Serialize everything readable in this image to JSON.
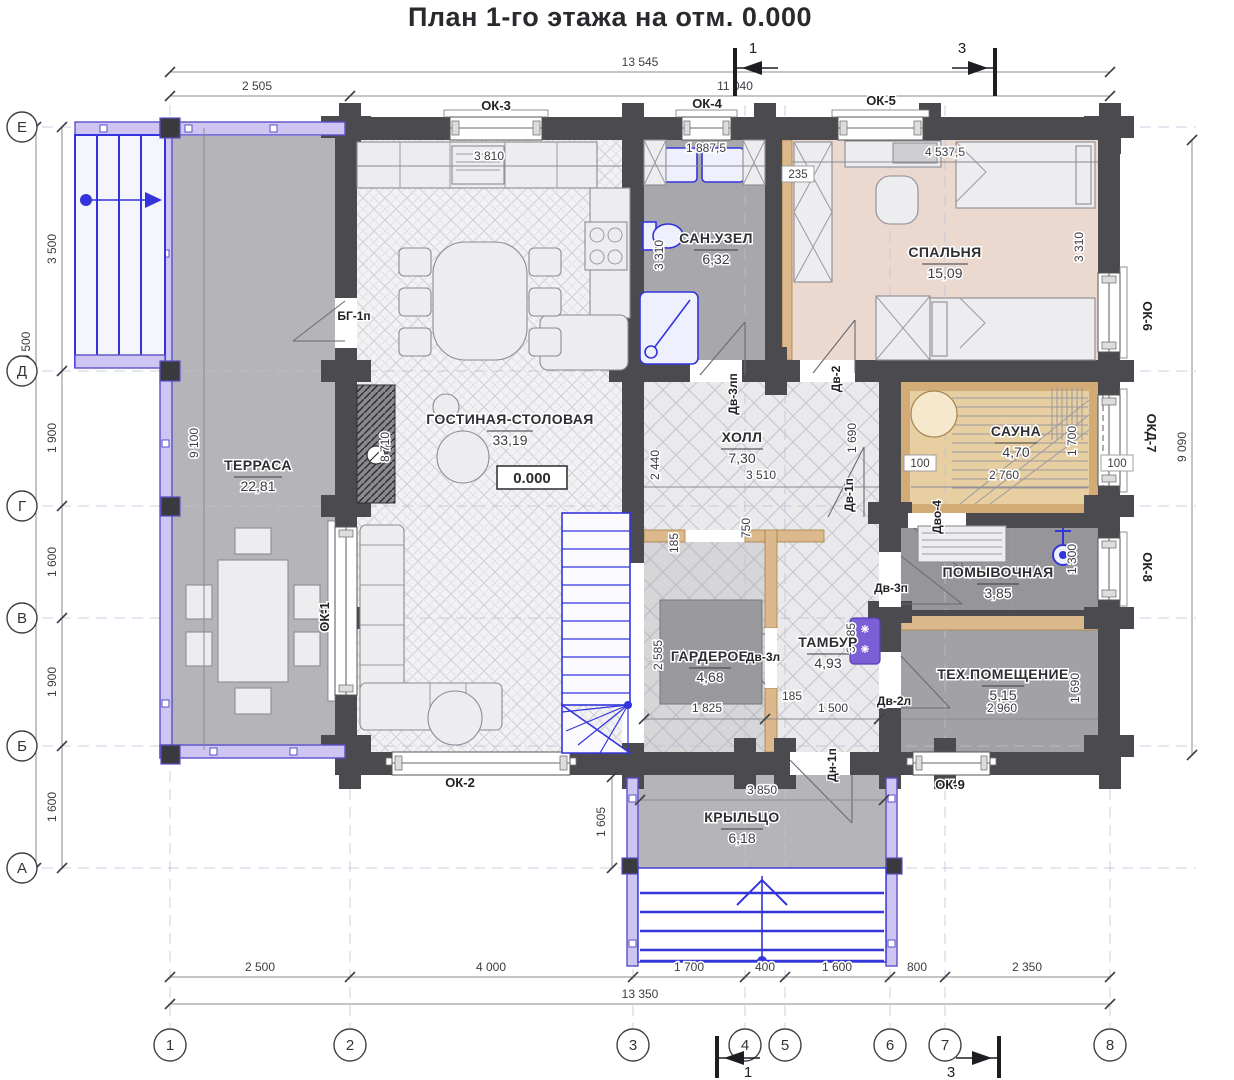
{
  "title": "План 1-го этажа на отм. 0.000",
  "elevation": "0.000",
  "rooms": {
    "terrasa": {
      "name": "ТЕРРАСА",
      "area": "22,81"
    },
    "gostinaya": {
      "name": "ГОСТИНАЯ-СТОЛОВАЯ",
      "area": "33,19"
    },
    "sanuzel": {
      "name": "САН.УЗЕЛ",
      "area": "6,32"
    },
    "spalnya": {
      "name": "СПАЛЬНЯ",
      "area": "15,09"
    },
    "holl": {
      "name": "ХОЛЛ",
      "area": "7,30"
    },
    "sauna": {
      "name": "САУНА",
      "area": "4,70"
    },
    "pomyvochnaya": {
      "name": "ПОМЫВОЧНАЯ",
      "area": "3,85"
    },
    "garderob": {
      "name": "ГАРДЕРОБ",
      "area": "4,68"
    },
    "tambur": {
      "name": "ТАМБУР",
      "area": "4,93"
    },
    "tehpom": {
      "name": "ТЕХ.ПОМЕЩЕНИЕ",
      "area": "5,15"
    },
    "krylco": {
      "name": "КРЫЛЬЦО",
      "area": "6,18"
    }
  },
  "windows": {
    "ok1": "ОК-1",
    "ok2": "ОК-2",
    "ok3": "ОК-3",
    "ok4": "ОК-4",
    "ok5": "ОК-5",
    "ok6": "ОК-6",
    "okd7": "ОКД-7",
    "ok8": "ОК-8",
    "ok9": "ОК-9"
  },
  "doors": {
    "bg1p": "БГ-1п",
    "dv3lp": "Дв-3лп",
    "dv2": "Дв-2",
    "dv1l": "Дв-1п",
    "dv3p": "Дв-3п",
    "dv3l": "Дв-3л",
    "dv2l": "Дв-2л",
    "dn1p": "Дн-1п",
    "dvo4": "Дво-4"
  },
  "axes": {
    "vertical": [
      "Е",
      "Д",
      "Г",
      "В",
      "Б",
      "А"
    ],
    "horizontal": [
      "1",
      "2",
      "3",
      "4",
      "5",
      "6",
      "7",
      "8"
    ]
  },
  "sections": {
    "one": "1",
    "three": "3"
  },
  "dimensions": {
    "top": {
      "total": "13 545",
      "inner": "11 040",
      "terrace": "2 505"
    },
    "bottom": {
      "segments": [
        "2 500",
        "4 000",
        "1 700",
        "400",
        "1 600",
        "800",
        "2 350"
      ],
      "total": "13 350"
    },
    "left": {
      "segments": [
        "3 500",
        "1 900",
        "1 600",
        "1 900",
        "1 600"
      ],
      "total": "10 500"
    },
    "right": {
      "total": "9 090"
    },
    "interior": {
      "d3810": "3 810",
      "d18875": "1 887,5",
      "d235": "235",
      "d45375": "4 537,5",
      "d3310a": "3 310",
      "d3310b": "3 310",
      "d9100": "9 100",
      "d8710": "8 710",
      "d2440": "2 440",
      "d3510": "3 510",
      "d1690a": "1 690",
      "d750": "750",
      "d185a": "185",
      "d100a": "100",
      "d2760": "2 760",
      "d1700": "1 700",
      "d100b": "100",
      "d1300": "1 300",
      "d2585": "2 585",
      "d1825": "1 825",
      "d185b": "185",
      "d1500": "1 500",
      "d3285": "3 285",
      "d2960": "2 960",
      "d1690b": "1 690",
      "d3850": "3 850",
      "d1605": "1 605"
    }
  },
  "colors": {
    "wall": "#4a4a4f",
    "plumbing_blue": "#3434dd",
    "sauna_wood": "#e7cfa2",
    "bedroom_pink": "#ebd9d0",
    "railing_purple": "#5a50c8",
    "partition_wood": "#dcb98c"
  }
}
